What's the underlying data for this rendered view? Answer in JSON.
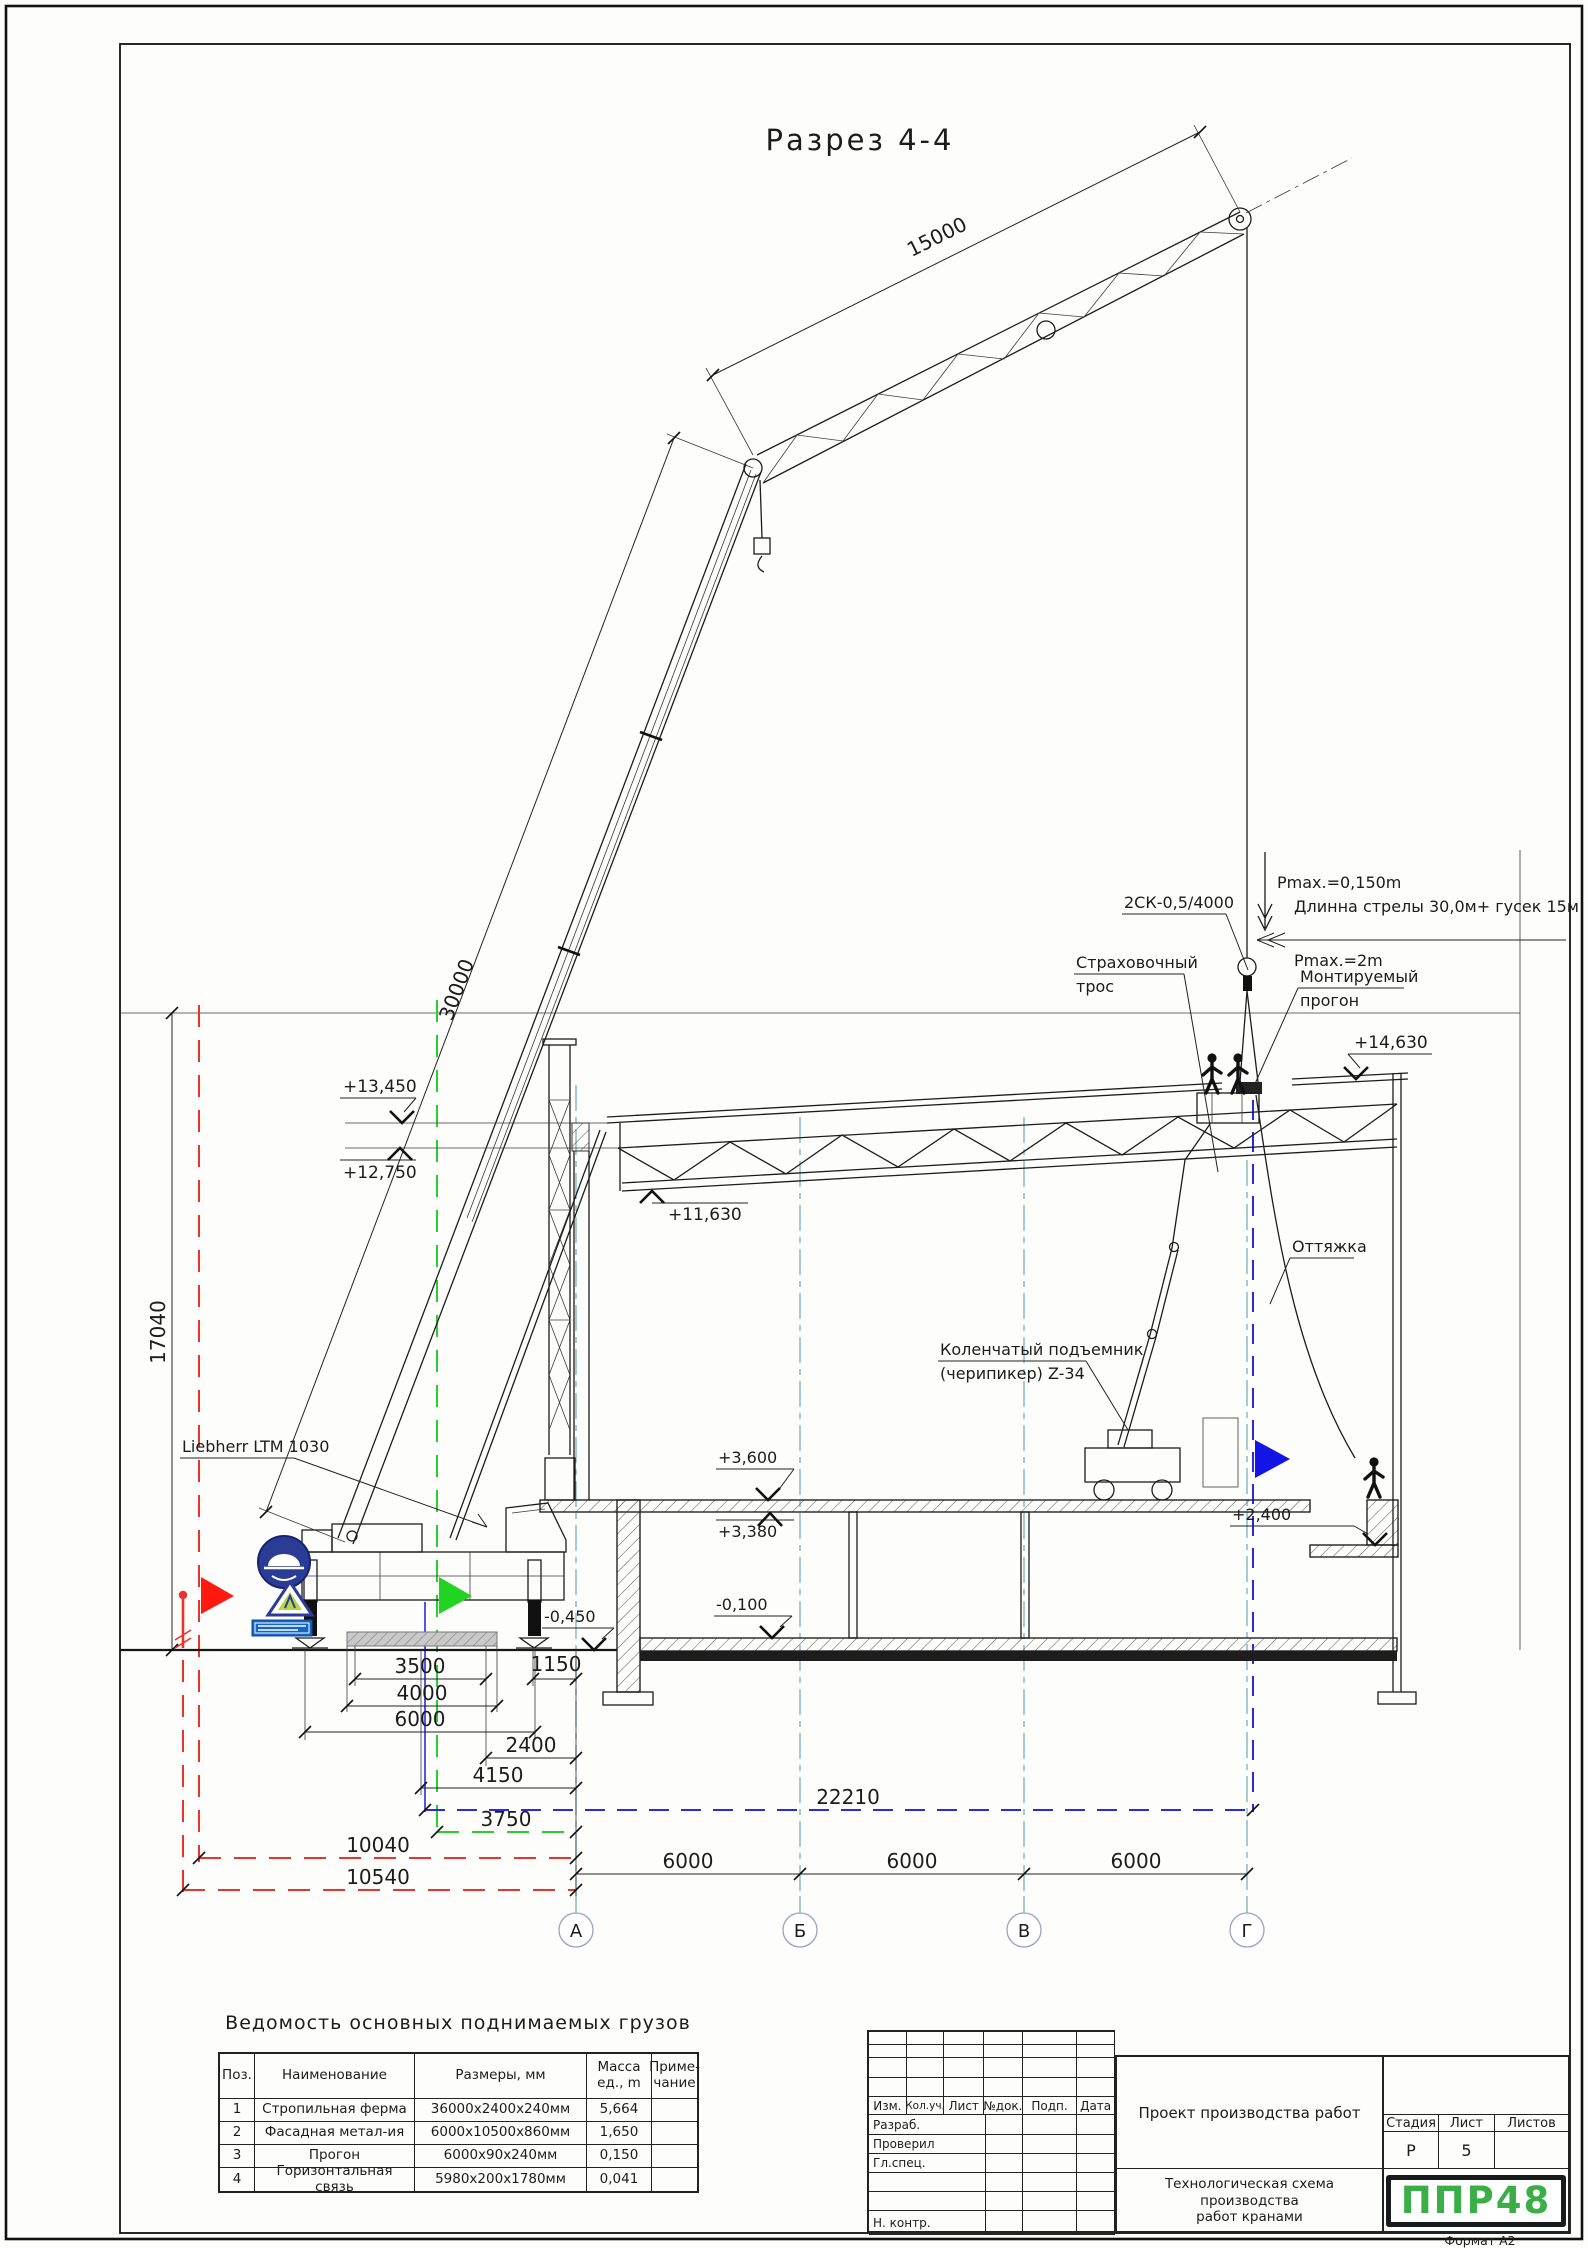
{
  "sheet": {
    "format_label": "Формат А2"
  },
  "drawing": {
    "title": "Разрез 4-4",
    "dims": {
      "jib": "15000",
      "boom": "30000",
      "height": "17040",
      "pad": "3500",
      "beam": "4000",
      "span": "6000",
      "edge": "1150",
      "d2400": "2400",
      "d4150": "4150",
      "d3750": "3750",
      "d10040": "10040",
      "d10540": "10540",
      "d22210": "22210",
      "bay1": "6000",
      "bay2": "6000",
      "bay3": "6000"
    },
    "elevations": {
      "e14630": "+14,630",
      "e13450": "+13,450",
      "e12750": "+12,750",
      "e11630": "+11,630",
      "e3600": "+3,600",
      "e3380": "+3,380",
      "e2400": "+2,400",
      "em100": "-0,100",
      "em450": "-0,450"
    },
    "labels": {
      "crane": "Liebherr LTM 1030",
      "sling": "2СК-0,5/4000",
      "pmax_top": "Pmax.=0,150m",
      "boom_len": "Длинна стрелы 30,0м+ гусек 15м",
      "pmax2": "Pmax.=2m",
      "safety1": "Страховочный",
      "safety2": "трос",
      "mounted1": "Монтируемый",
      "mounted2": "прогон",
      "guy": "Оттяжка",
      "lift1": "Коленчатый подъемник",
      "lift2": "(черипикер) Z-34"
    },
    "axes": [
      "А",
      "Б",
      "В",
      "Г"
    ]
  },
  "load_table": {
    "title": "Ведомость основных поднимаемых грузов",
    "headers": [
      "Поз.",
      "Наименование",
      "Размеры, мм",
      "Масса ед., m",
      "Приме- чание"
    ],
    "rows": [
      [
        "1",
        "Стропильная ферма",
        "36000х2400х240мм",
        "5,664",
        ""
      ],
      [
        "2",
        "Фасадная метал-ия",
        "6000х10500х860мм",
        "1,650",
        ""
      ],
      [
        "3",
        "Прогон",
        "6000х90х240мм",
        "0,150",
        ""
      ],
      [
        "4",
        "Горизонтальная связь",
        "5980х200х1780мм",
        "0,041",
        ""
      ]
    ]
  },
  "title_block": {
    "revision_headers": [
      "Изм.",
      "Кол.уч.",
      "Лист",
      "№док.",
      "Подп.",
      "Дата"
    ],
    "roles": [
      "Разраб.",
      "Проверил",
      "Гл.спец.",
      "",
      "",
      "Н. контр."
    ],
    "project": "Проект производства работ",
    "doc_title_1": "Технологическая схема производства",
    "doc_title_2": "работ кранами",
    "stage_label": "Стадия",
    "sheet_label": "Лист",
    "sheets_label": "Листов",
    "stage": "Р",
    "sheet_no": "5",
    "sheets": "",
    "logo": "ППР48"
  },
  "colors": {
    "accent_red": "#e8342a",
    "accent_green": "#27d02c",
    "accent_blue": "#2a2ae0",
    "axis_teal": "#74b6b6",
    "logo_green": "#3cae47",
    "sign_blue": "#2b3c97"
  }
}
